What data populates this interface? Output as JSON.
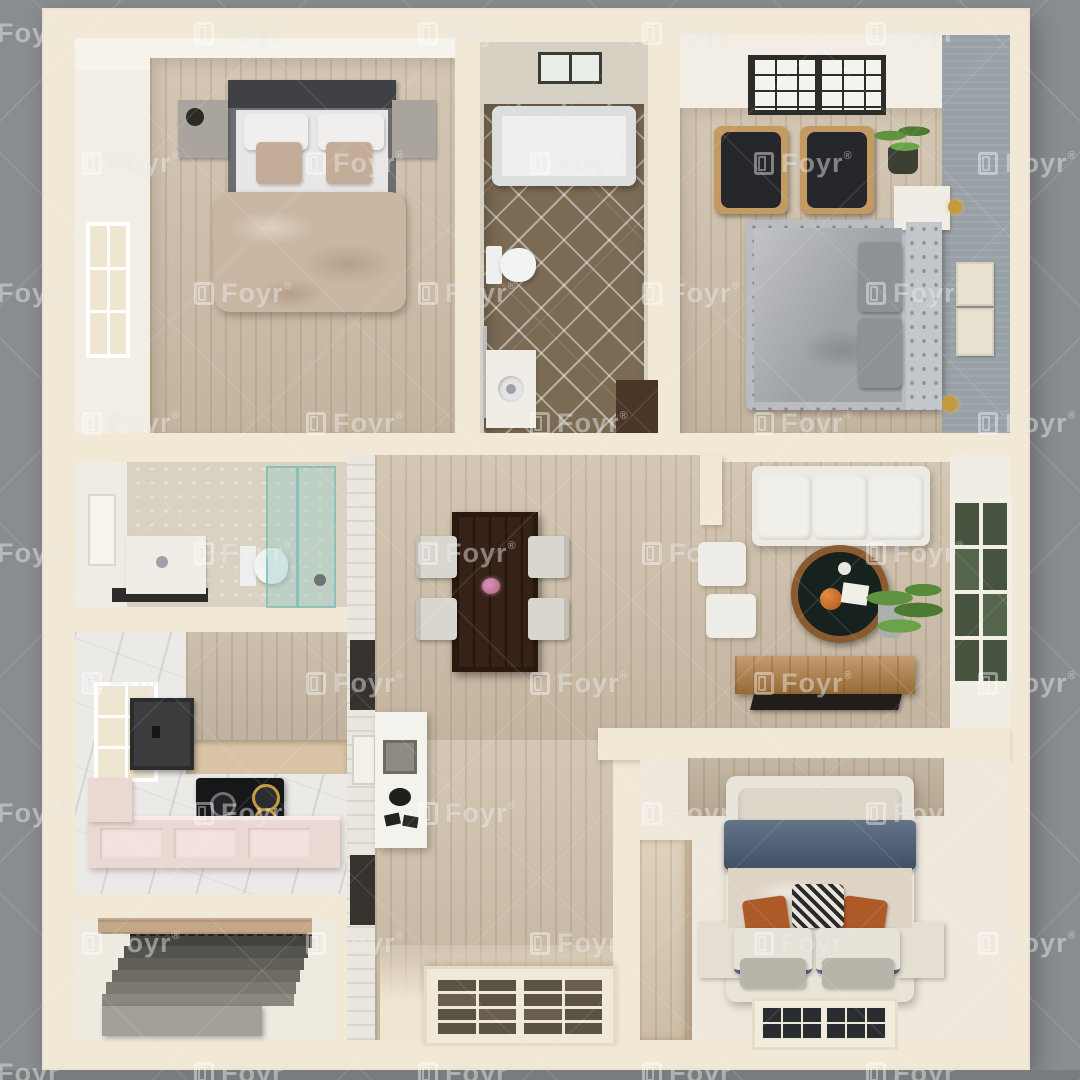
{
  "watermark": {
    "text": "Foyr",
    "reg": "®",
    "color": "rgba(255,255,255,0.40)"
  },
  "background": {
    "outer": "#8a8d90",
    "outer_bottom_strip": "#797c7f"
  },
  "palette": {
    "wall_cream": "#f1e8d6",
    "wall_face_white": "#f2eee6",
    "wood_floor": "#cfc1ac",
    "wood_panel": "#c2a888",
    "bathroom_tile_brown": "#7b6b54",
    "accent_wall_gray": "#98a1a7",
    "marble": "#eceae7",
    "kitchen_cabinet_pink": "#ecd8d3",
    "cooktop_black": "#151719",
    "sofa_white": "#eceae3",
    "navy_blanket": "#4e6078",
    "duvet_beige": "#cab7a3",
    "dining_table_wood": "#372218",
    "plant_green": "#5f9340",
    "gold_accent": "#c59a3f",
    "stairs_gray": "#55534e",
    "armchair_black": "#26272a"
  },
  "rooms": [
    {
      "name": "bedroom-top-left",
      "furniture": [
        "double-bed",
        "headboard",
        "nightstand-left",
        "nightstand-right",
        "duvet",
        "window-left-wall"
      ]
    },
    {
      "name": "bathroom-top-center",
      "furniture": [
        "bathtub",
        "toilet",
        "vanity-sink",
        "towel-bar",
        "skylight",
        "diamond-tile-floor"
      ]
    },
    {
      "name": "bedroom-top-right",
      "furniture": [
        "tufted-bed",
        "armchair",
        "armchair",
        "potted-plant",
        "nightstand",
        "wall-sconce",
        "wall-sconce",
        "wall-art",
        "wall-art",
        "skylight"
      ]
    },
    {
      "name": "bathroom-middle-left",
      "furniture": [
        "vanity-sink",
        "toilet",
        "glass-shower",
        "wall-niche"
      ]
    },
    {
      "name": "kitchen",
      "furniture": [
        "window",
        "range-hood",
        "tall-cabinets",
        "cooktop",
        "pink-counter"
      ]
    },
    {
      "name": "staircase-room",
      "furniture": [
        "stairs"
      ]
    },
    {
      "name": "dining-hall",
      "furniture": [
        "dining-table",
        "flower-centerpiece",
        "chair",
        "chair",
        "chair",
        "chair",
        "console-table",
        "wall-panel",
        "wall-panel",
        "french-entry-door"
      ]
    },
    {
      "name": "living-room",
      "furniture": [
        "sofa",
        "ottoman",
        "ottoman",
        "round-coffee-table",
        "potted-plant",
        "window-right-wall",
        "tv-console",
        "tv"
      ]
    },
    {
      "name": "bedroom-bottom-right",
      "furniture": [
        "double-bed",
        "navy-blanket",
        "accent-pillows",
        "patterned-pillow",
        "wardrobe",
        "nightstand-left",
        "nightstand-right",
        "window-bottom-wall"
      ]
    }
  ]
}
